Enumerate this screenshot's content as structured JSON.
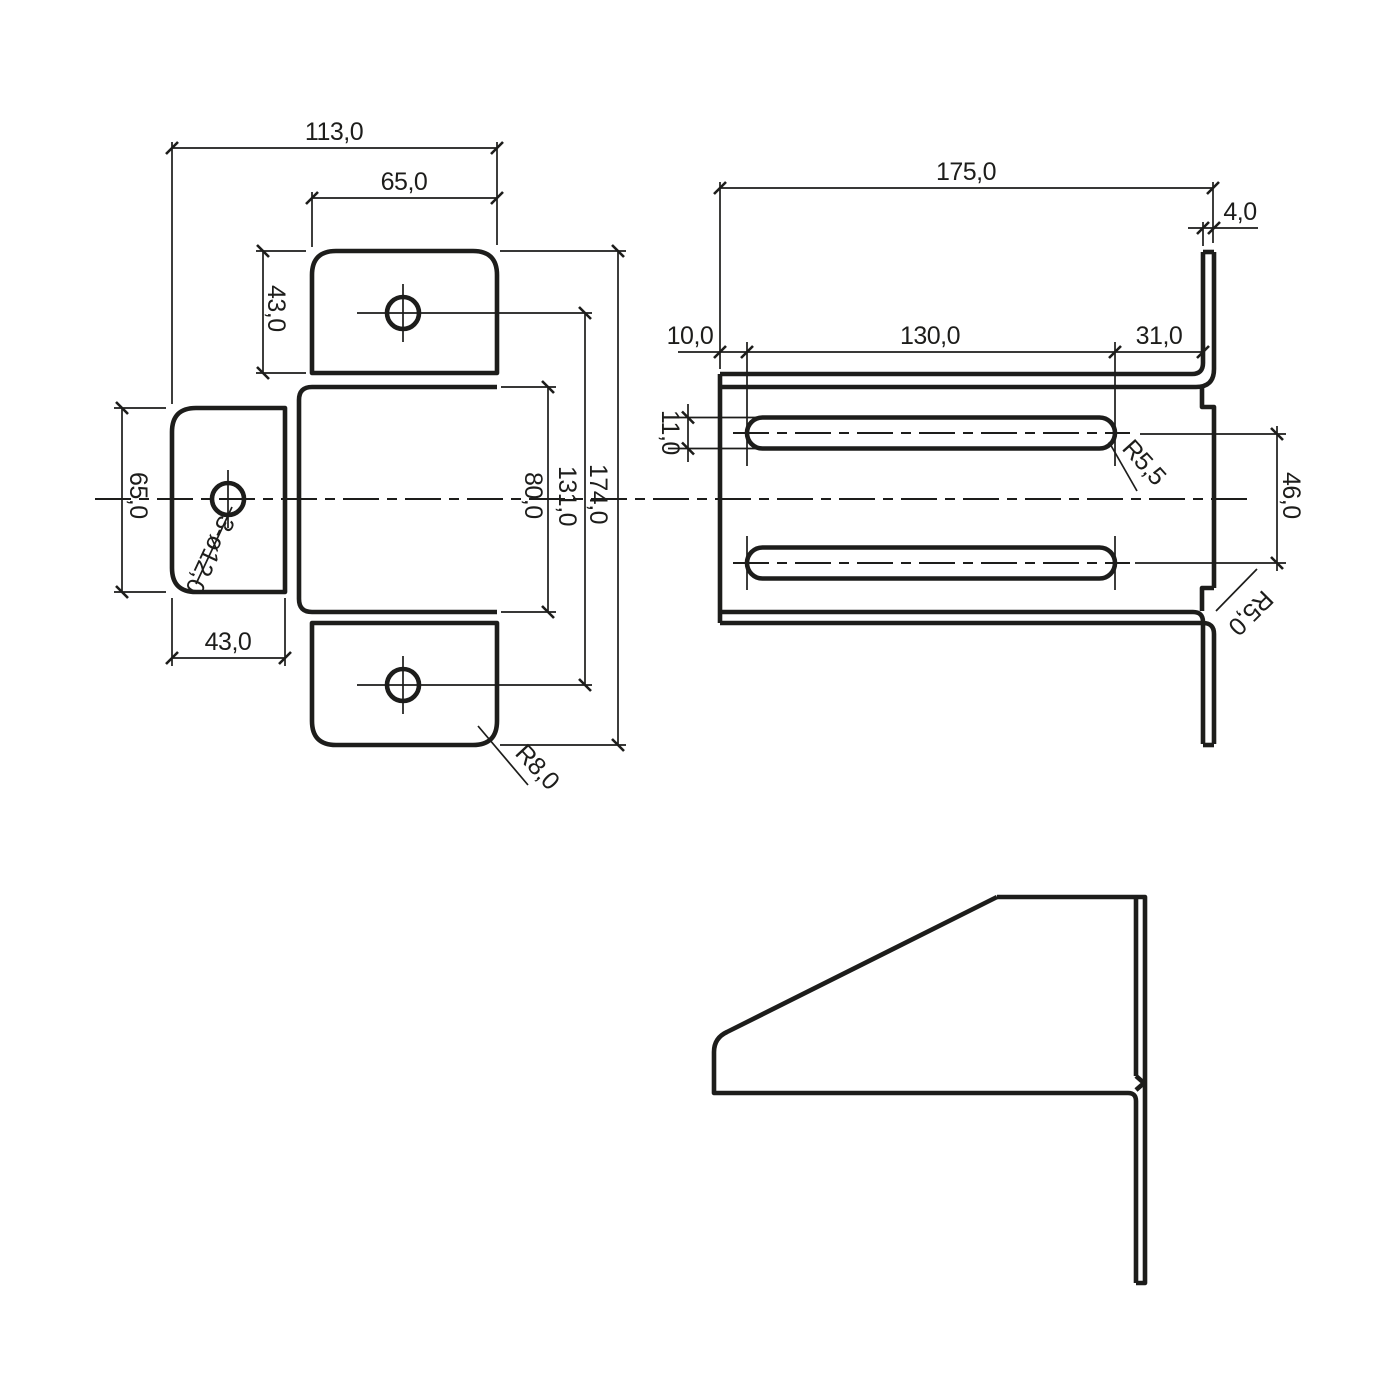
{
  "drawing": {
    "type": "technical-drawing",
    "subject": "sheet-metal bracket, three orthographic views",
    "colors": {
      "line": "#1d1d1b",
      "background": "#ffffff"
    },
    "left_view": {
      "dims": {
        "overall_width": "113,0",
        "top_tab_width": "65,0",
        "top_tab_height": "43,0",
        "left_tab_height": "65,0",
        "left_tab_width": "43,0",
        "body_height": "80,0",
        "hole_spacing": "131,0",
        "overall_height": "174,0"
      },
      "leaders": {
        "holes": "3-ø12,0",
        "corner_radius": "R8,0"
      }
    },
    "right_view": {
      "dims": {
        "overall_length": "175,0",
        "thickness": "4,0",
        "slot_start_offset": "10,0",
        "slot_length": "130,0",
        "slot_end_offset": "31,0",
        "slot_width": "11,0",
        "slot_spacing": "46,0"
      },
      "leaders": {
        "slot_radius": "R5,5",
        "bend_radius": "R5,0"
      }
    }
  }
}
